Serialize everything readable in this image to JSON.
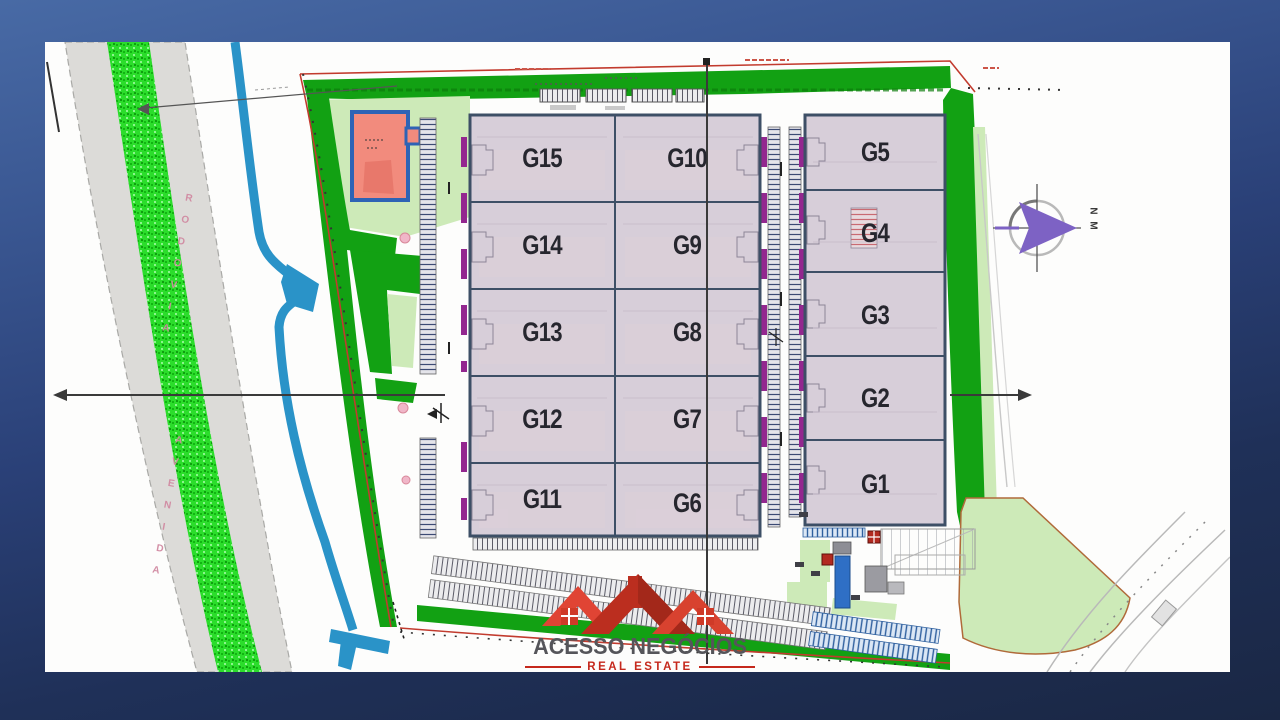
{
  "plan": {
    "main_building": {
      "left_units": [
        "G15",
        "G14",
        "G13",
        "G12",
        "G11"
      ],
      "right_units": [
        "G10",
        "G9",
        "G8",
        "G7",
        "G6"
      ]
    },
    "annex_building": {
      "units": [
        "G5",
        "G4",
        "G3",
        "G2",
        "G1"
      ]
    },
    "left_road": {
      "label_upper": "RODOVIA",
      "label_lower": "AVENIDA"
    },
    "compass_label": "N M"
  },
  "logo": {
    "title": "ACESSO NEGÓCIOS",
    "subtitle": "REAL ESTATE"
  },
  "colors": {
    "paper": "#fdfdfc",
    "building_fill": "#d7ced9",
    "building_border": "#3d4f66",
    "dark_green": "#12a113",
    "light_green": "#cdeab8",
    "median_green": "#2bdd2b",
    "water_blue": "#2a93c8",
    "boundary_red": "#c23b2e",
    "dock_purple": "#93278f",
    "compass_purple": "#7d62c4",
    "logo_red": "#c0281c",
    "gatehouse_pink": "#f28b7d",
    "label_color": "#26262e"
  }
}
